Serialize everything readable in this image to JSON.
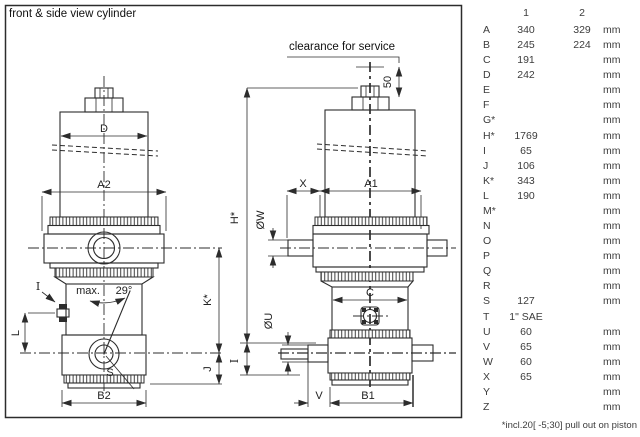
{
  "title": "front & side view cylinder",
  "drawing": {
    "front_view": {
      "dim_d": "D",
      "dim_a2": "A2",
      "angle_prefix": "max.",
      "angle_value": "29°",
      "dim_i": "I",
      "dim_l": "L",
      "dim_k": "K*",
      "dim_j": "J",
      "dim_s": "S",
      "dim_b2": "B2"
    },
    "side_view": {
      "clearance_note": "clearance for service",
      "dim_50": "50",
      "dim_x": "X",
      "dim_a1": "A1",
      "dim_h": "H*",
      "dim_w": "ØW",
      "dim_c": "C",
      "dim_u": "ØU",
      "dim_i": "I",
      "dim_v": "V",
      "dim_b1": "B1"
    }
  },
  "table": {
    "headers": {
      "col1": "1",
      "col2": "2"
    },
    "rows": [
      {
        "label": "A",
        "v1": "340",
        "v2": "329",
        "unit": "mm"
      },
      {
        "label": "B",
        "v1": "245",
        "v2": "224",
        "unit": "mm"
      },
      {
        "label": "C",
        "v1": "191",
        "v2": "",
        "unit": "mm"
      },
      {
        "label": "D",
        "v1": "242",
        "v2": "",
        "unit": "mm"
      },
      {
        "label": "E",
        "v1": "",
        "v2": "",
        "unit": "mm"
      },
      {
        "label": "F",
        "v1": "",
        "v2": "",
        "unit": "mm"
      },
      {
        "label": "G*",
        "v1": "",
        "v2": "",
        "unit": "mm"
      },
      {
        "label": "H*",
        "v1": "1769",
        "v2": "",
        "unit": "mm"
      },
      {
        "label": "I",
        "v1": "65",
        "v2": "",
        "unit": "mm"
      },
      {
        "label": "J",
        "v1": "106",
        "v2": "",
        "unit": "mm"
      },
      {
        "label": "K*",
        "v1": "343",
        "v2": "",
        "unit": "mm"
      },
      {
        "label": "L",
        "v1": "190",
        "v2": "",
        "unit": "mm"
      },
      {
        "label": "M*",
        "v1": "",
        "v2": "",
        "unit": "mm"
      },
      {
        "label": "N",
        "v1": "",
        "v2": "",
        "unit": "mm"
      },
      {
        "label": "O",
        "v1": "",
        "v2": "",
        "unit": "mm"
      },
      {
        "label": "P",
        "v1": "",
        "v2": "",
        "unit": "mm"
      },
      {
        "label": "Q",
        "v1": "",
        "v2": "",
        "unit": "mm"
      },
      {
        "label": "R",
        "v1": "",
        "v2": "",
        "unit": "mm"
      },
      {
        "label": "S",
        "v1": "127",
        "v2": "",
        "unit": "mm"
      },
      {
        "label": "T",
        "v1": "1\" SAE",
        "v2": "",
        "unit": ""
      },
      {
        "label": "U",
        "v1": "60",
        "v2": "",
        "unit": "mm"
      },
      {
        "label": "V",
        "v1": "65",
        "v2": "",
        "unit": "mm"
      },
      {
        "label": "W",
        "v1": "60",
        "v2": "",
        "unit": "mm"
      },
      {
        "label": "X",
        "v1": "65",
        "v2": "",
        "unit": "mm"
      },
      {
        "label": "Y",
        "v1": "",
        "v2": "",
        "unit": "mm"
      },
      {
        "label": "Z",
        "v1": "",
        "v2": "",
        "unit": "mm"
      }
    ],
    "footnote": "*incl.20[ -5;30] pull out on piston"
  }
}
